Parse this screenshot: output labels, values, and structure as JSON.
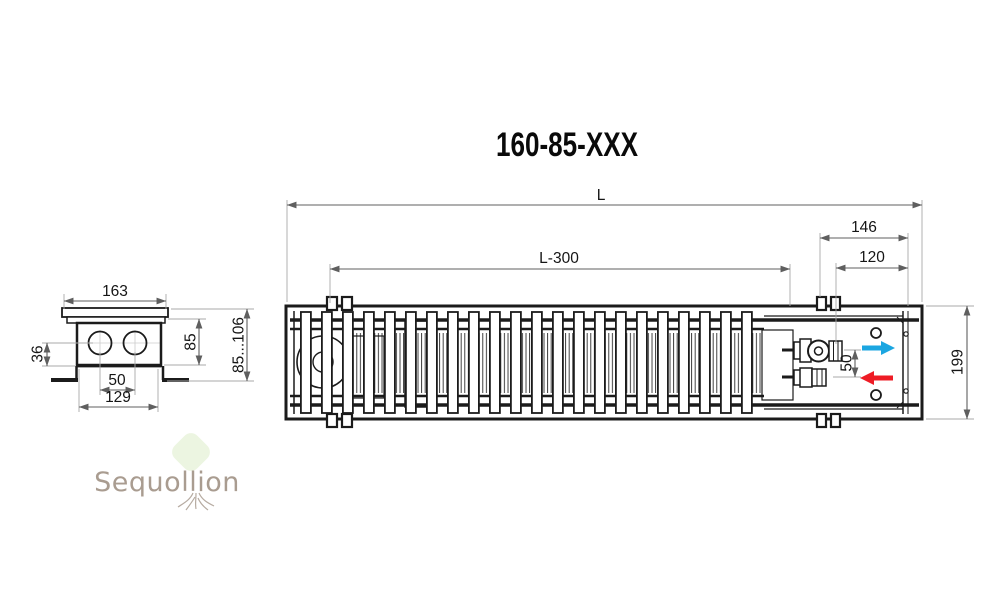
{
  "title": "160-85-XXX",
  "side_view": {
    "top_width": "163",
    "pipe_axis_to_bottom": "36",
    "pipe_spacing": "50",
    "bottom_width": "129",
    "body_height": "85",
    "install_height_range": "85...106"
  },
  "top_view": {
    "total_length": "L",
    "grille_length": "L-300",
    "end_section_length": "146",
    "connection_offset": "120",
    "connection_spacing": "50",
    "body_width": "199"
  },
  "flow": {
    "supply_color": "#1ba6e1",
    "return_color": "#ee1c25"
  },
  "watermark": {
    "brand": "Sequollion"
  }
}
